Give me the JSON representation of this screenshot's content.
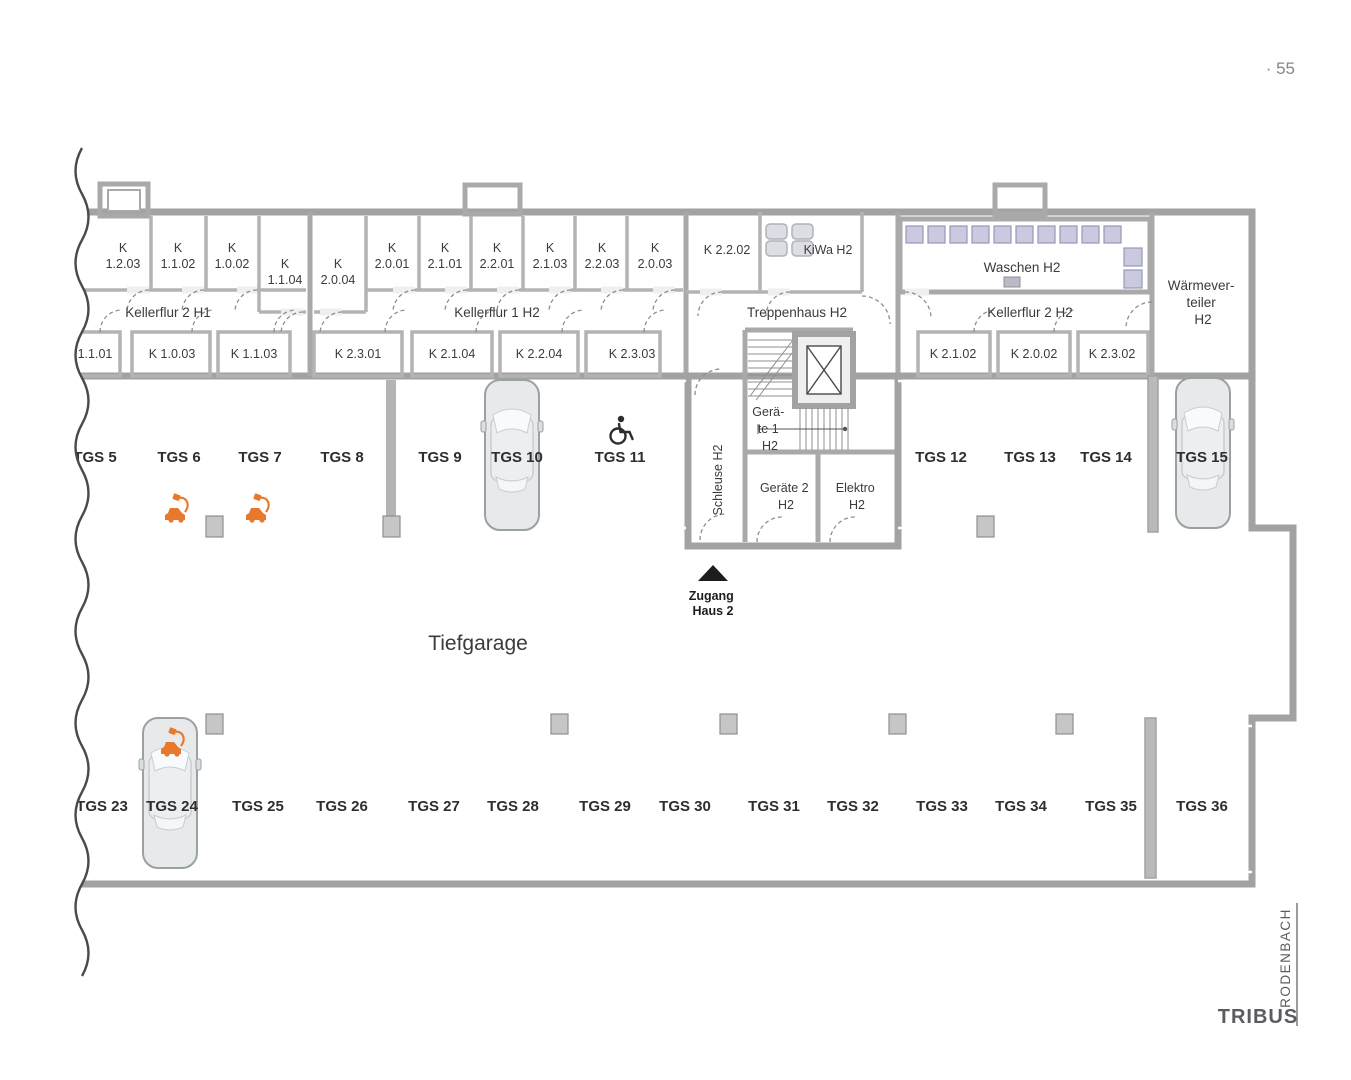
{
  "page": {
    "number": "· 55",
    "title": "Tiefgarage",
    "brand": "TRIBUS",
    "brand_location": "RODENBACH"
  },
  "entrance": {
    "line1": "Zugang",
    "line2": "Haus 2"
  },
  "corridors": {
    "left": "Kellerflur 2 H1",
    "middle": "Kellerflur 1 H2",
    "right": "Kellerflur 2 H2",
    "stair": "Treppenhaus H2"
  },
  "rooms": {
    "kiwa": "KiWa H2",
    "waschen": "Waschen H2",
    "k2202": "K 2.2.02",
    "schleuse": "Schleuse H2",
    "waermeverteiler": [
      "Wärmever-",
      "teiler",
      "H2"
    ],
    "geraete1": [
      "Gerä-",
      "te 1",
      "H2"
    ],
    "geraete2": [
      "Geräte 2",
      "H2"
    ],
    "elektro": [
      "Elektro",
      "H2"
    ]
  },
  "kellers_top": [
    {
      "prefix": "K",
      "number": "1.2.03"
    },
    {
      "prefix": "K",
      "number": "1.1.02"
    },
    {
      "prefix": "K",
      "number": "1.0.02"
    },
    {
      "prefix": "K",
      "number": "1.1.04"
    },
    {
      "prefix": "K",
      "number": "2.0.04"
    },
    {
      "prefix": "K",
      "number": "2.0.01"
    },
    {
      "prefix": "K",
      "number": "2.1.01"
    },
    {
      "prefix": "K",
      "number": "2.2.01"
    },
    {
      "prefix": "K",
      "number": "2.1.03"
    },
    {
      "prefix": "K",
      "number": "2.2.03"
    },
    {
      "prefix": "K",
      "number": "2.0.03"
    }
  ],
  "kellers_bottom": [
    "1.1.01",
    "K 1.0.03",
    "K 1.1.03",
    "K 2.3.01",
    "K 2.1.04",
    "K 2.2.04",
    "K 2.3.03",
    "K 2.1.02",
    "K 2.0.02",
    "K 2.3.02"
  ],
  "parking": {
    "top_row": [
      "TGS 5",
      "TGS 6",
      "TGS 7",
      "TGS 8",
      "TGS 9",
      "TGS 10",
      "TGS 11",
      "TGS 12",
      "TGS 13",
      "TGS 14",
      "TGS 15"
    ],
    "bottom_row": [
      "TGS 23",
      "TGS 24",
      "TGS 25",
      "TGS 26",
      "TGS 27",
      "TGS 28",
      "TGS 29",
      "TGS 30",
      "TGS 31",
      "TGS 32",
      "TGS 33",
      "TGS 34",
      "TGS 35",
      "TGS 36"
    ]
  },
  "icons": {
    "wheelchair": "accessible-parking",
    "ev_charging": "ev-charging-spot",
    "entrance_arrow": "entrance-triangle",
    "stroller": "stroller",
    "washing_machine": "washing-machine",
    "car": "car-top-view"
  },
  "colors": {
    "floor": "#acacac",
    "room": "#f0efee",
    "wall": "#a2a2a2",
    "laundry_bg": "#e9e9f3",
    "laundry_unit": "#c9c9e0",
    "accent_orange": "#e8792c",
    "text": "#3b3b3b",
    "muted": "#868686",
    "brand": "#5b5b60"
  }
}
